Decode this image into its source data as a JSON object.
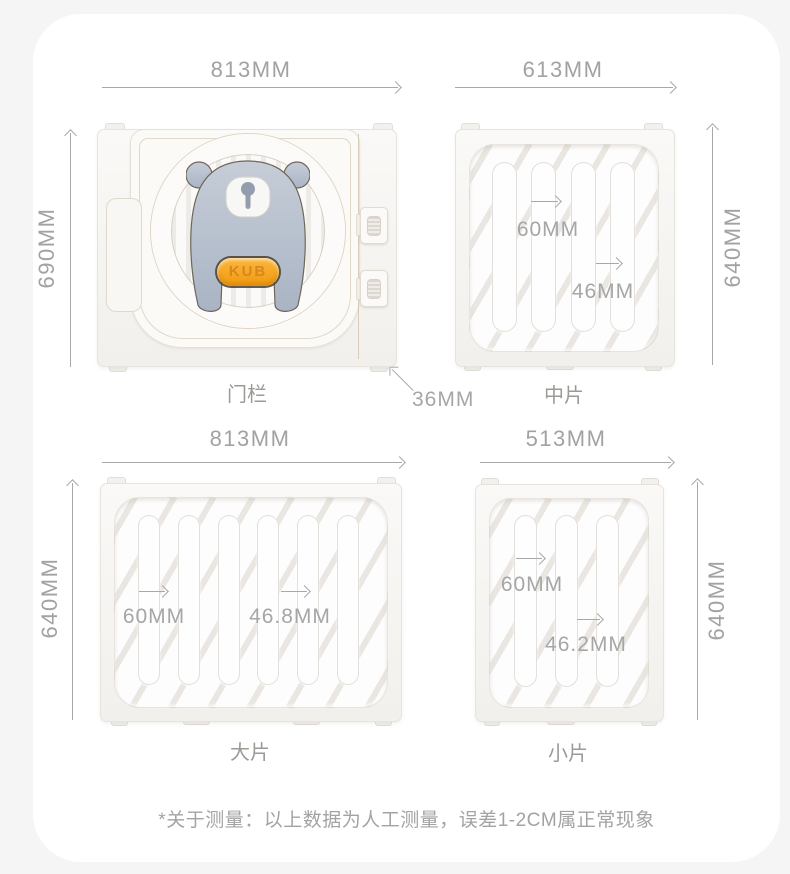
{
  "page": {
    "footnote": "*关于测量：以上数据为人工测量，误差1-2CM属正常现象"
  },
  "colors": {
    "page_background": "#f5f5f6",
    "card_background": "#ffffff",
    "panel_white": "#f6f4f1",
    "dimension_gray": "#a2a2a2",
    "bear_gray": "#b7c0cd",
    "badge_orange": "#f5a21b"
  },
  "panels": [
    {
      "id": "door",
      "label": "门栏",
      "width_label": "813MM",
      "height_label": "690MM",
      "thickness_label": "36MM",
      "logo_text": "KUB"
    },
    {
      "id": "middle",
      "label": "中片",
      "width_label": "613MM",
      "height_label": "640MM",
      "slot_width_label": "60MM",
      "bar_width_label": "46MM",
      "slot_count": 4
    },
    {
      "id": "large",
      "label": "大片",
      "width_label": "813MM",
      "height_label": "640MM",
      "slot_width_label": "60MM",
      "bar_width_label": "46.8MM",
      "slot_count": 6
    },
    {
      "id": "small",
      "label": "小片",
      "width_label": "513MM",
      "height_label": "640MM",
      "slot_width_label": "60MM",
      "bar_width_label": "46.2MM",
      "slot_count": 3
    }
  ]
}
